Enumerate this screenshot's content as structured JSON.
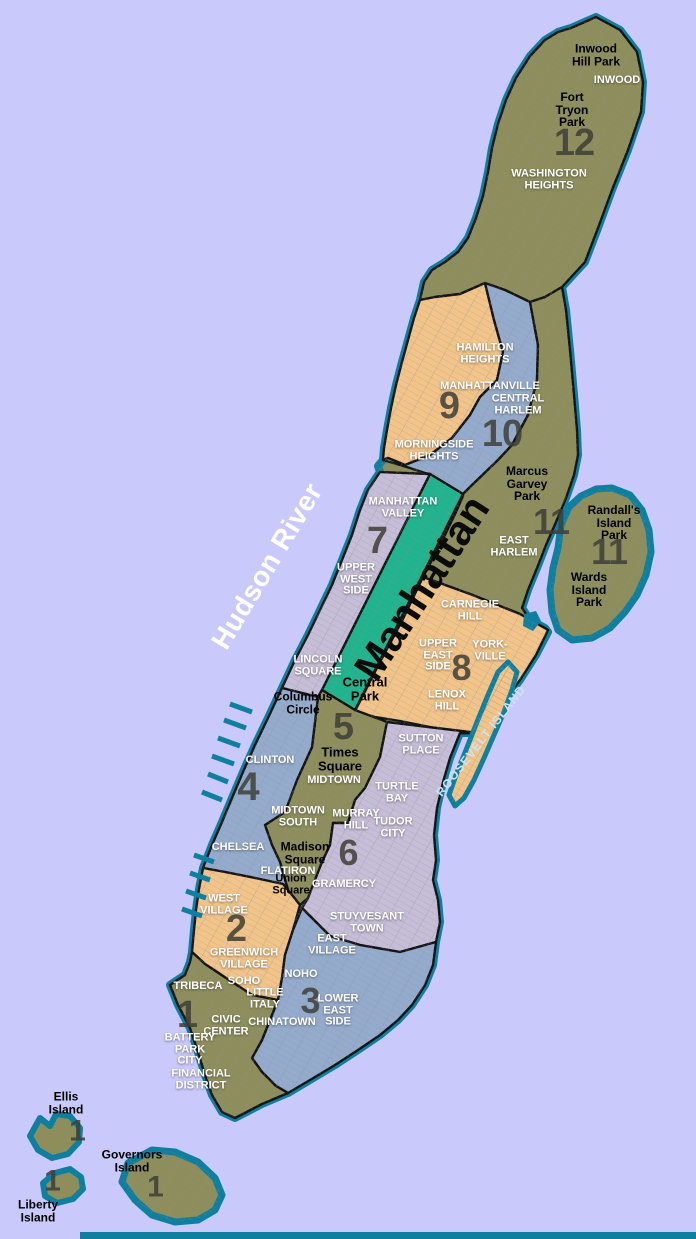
{
  "colors": {
    "water": "#c9c9fb",
    "shore": "#0e7f9e",
    "boundary": "#141414",
    "olive": "#8e8e5c",
    "orange": "#f2c489",
    "blue": "#94abcd",
    "lavender": "#c6bdd8",
    "park": "#1fb48e",
    "street": "#8f8f8f",
    "numeral": "#3f3f37",
    "label_white": "#ffffff",
    "label_black": "#000000",
    "roosevelt_text": "#cfe2f2"
  },
  "map": {
    "width": 696,
    "height": 1239,
    "shapes": [
      {
        "name": "manhattan-island",
        "fill": "olive",
        "stroke": "shore",
        "sw": 8,
        "overlay": true,
        "points": "571,28 596,17 620,30 637,52 643,82 641,112 628,150 612,190 598,228 585,262 562,287 566,310 570,350 574,395 577,430 578,455 574,475 566,498 556,522 546,545 537,568 528,590 522,608 530,620 545,628 548,632 536,655 520,680 505,700 490,718 478,733 460,733 450,758 443,782 437,808 434,835 436,860 433,880 438,900 440,922 436,942 433,965 425,985 412,1005 398,1020 380,1035 358,1050 335,1065 310,1080 288,1093 262,1104 235,1118 222,1112 212,1095 205,1075 198,1052 190,1028 178,1005 170,985 185,975 190,962 192,952 194,930 196,910 199,889 203,868 212,845 222,822 232,798 243,772 255,745 268,718 282,688 295,660 308,635 320,610 332,585 342,560 352,535 360,510 368,490 380,472 378,466 383,460 384,448 387,430 391,408 396,385 402,362 408,340 414,318 420,300 424,282 432,270 445,262 458,252 468,238 476,218 483,196 488,172 492,148 498,124 506,100 516,78 530,56 545,40 558,32"
      },
      {
        "name": "district-12",
        "fill": "olive",
        "stroke": "boundary",
        "sw": 2.4,
        "points": "420,300 435,297 460,294 485,283 505,290 530,302 545,297 562,287 585,262 598,228 612,190 628,150 641,112 643,82 637,52 620,30 596,17 571,28 558,32 545,40 530,56 516,78 506,100 498,124 492,148 488,172 483,196 476,218 468,238 458,252 445,262 432,270 424,282"
      },
      {
        "name": "district-9",
        "fill": "orange",
        "stroke": "boundary",
        "sw": 2.4,
        "points": "420,300 435,297 460,294 485,283 494,320 503,352 497,380 480,397 470,415 452,438 430,455 405,465 388,458 383,460 384,448 387,430 391,408 396,385 402,362 408,340 414,318"
      },
      {
        "name": "district-10",
        "fill": "blue",
        "stroke": "boundary",
        "sw": 2.4,
        "points": "485,283 505,290 530,302 538,345 537,380 528,415 512,445 498,460 470,487 463,494 430,474 425,473 410,468 390,462 383,460 388,458 405,465 430,455 452,438 470,415 480,397 497,380 503,352 494,320"
      },
      {
        "name": "district-11",
        "fill": "olive",
        "stroke": "boundary",
        "sw": 2.4,
        "points": "530,302 545,297 562,287 566,310 570,350 574,395 577,430 578,455 574,475 566,498 556,522 546,545 537,568 528,590 522,608 530,620 545,628 548,630 520,614 470,594 423,577 432,560 445,535 456,512 463,496 463,494 470,487 498,460 512,445 528,415 537,380 538,345"
      },
      {
        "name": "district-7",
        "fill": "lavender",
        "stroke": "boundary",
        "sw": 2.4,
        "points": "380,472 430,474 322,690 318,697 282,688 295,660 308,635 320,610 332,585 342,560 352,535 360,510 368,490"
      },
      {
        "name": "central-park",
        "fill": "park",
        "stroke": "boundary",
        "sw": 2.4,
        "points": "430,474 463,494 355,710 322,690"
      },
      {
        "name": "district-8",
        "fill": "orange",
        "stroke": "boundary",
        "sw": 2.4,
        "points": "423,577 470,594 520,614 548,630 536,655 520,680 505,700 490,718 478,733 460,733 430,727 400,721 375,717 355,711 380,662 402,621"
      },
      {
        "name": "district-5",
        "fill": "olive",
        "stroke": "boundary",
        "sw": 2.4,
        "points": "322,690 355,710 387,722 380,757 365,788 355,800 348,823 333,823 330,845 322,862 315,880 308,898 300,905 288,890 280,862 272,845 265,825 285,812 297,780 312,747 318,697"
      },
      {
        "name": "district-4",
        "fill": "blue",
        "stroke": "boundary",
        "sw": 2.4,
        "points": "282,688 318,697 312,747 297,780 285,812 265,825 272,845 280,862 288,890 283,884 255,878 225,872 203,868 212,845 222,822 232,798 243,772 255,745 268,718"
      },
      {
        "name": "district-6",
        "fill": "lavender",
        "stroke": "boundary",
        "sw": 2.4,
        "points": "387,722 478,733 460,733 450,758 443,782 437,808 434,835 436,860 433,880 438,900 440,922 436,942 400,952 360,945 330,936 302,908 308,898 315,880 322,862 330,845 333,823 348,823 355,800 365,788 380,757"
      },
      {
        "name": "district-2",
        "fill": "orange",
        "stroke": "boundary",
        "sw": 2.4,
        "points": "203,868 225,872 255,878 283,884 288,890 300,905 293,930 285,955 282,978 278,1000 252,995 226,978 205,964 192,952 194,930 196,910 199,889"
      },
      {
        "name": "district-3",
        "fill": "blue",
        "stroke": "boundary",
        "sw": 2.4,
        "points": "302,908 330,936 360,945 400,952 436,942 433,965 425,985 412,1005 398,1020 380,1035 358,1050 335,1065 310,1080 288,1093 276,1086 262,1072 252,1058 262,1040 270,1020 278,1000 282,978 285,955 293,930"
      },
      {
        "name": "district-1",
        "fill": "olive",
        "stroke": "boundary",
        "sw": 2.4,
        "points": "192,952 205,964 226,978 252,995 278,1000 270,1020 262,1040 252,1058 262,1072 276,1086 288,1093 262,1104 235,1118 222,1112 212,1095 205,1075 198,1052 190,1028 178,1005 170,985 185,975 190,962"
      },
      {
        "name": "randalls-wards-island",
        "fill": "olive",
        "stroke": "shore",
        "sw": 7,
        "overlay": true,
        "points": "612,488 630,495 642,510 649,530 651,552 646,575 637,595 625,612 610,628 592,638 572,640 558,630 552,612 550,590 553,568 558,548 561,525 569,507 581,496 596,489"
      },
      {
        "name": "roosevelt-island",
        "fill": "orange",
        "stroke": "shore",
        "sw": 5,
        "overlay": true,
        "points": "508,662 517,672 512,690 504,712 494,735 484,758 474,780 464,798 455,806 449,795 456,775 466,750 477,722 488,695 498,672"
      },
      {
        "name": "governors-island",
        "fill": "olive",
        "stroke": "shore",
        "sw": 7,
        "overlay": true,
        "points": "152,1150 175,1152 198,1162 215,1178 222,1195 215,1210 198,1220 175,1222 152,1215 135,1200 122,1182 128,1163"
      },
      {
        "name": "ellis-island",
        "fill": "olive",
        "stroke": "shore",
        "sw": 6,
        "points": "40,1118 50,1126 56,1114 70,1116 80,1128 79,1142 68,1154 52,1158 38,1150 30,1136"
      },
      {
        "name": "liberty-island",
        "fill": "olive",
        "stroke": "shore",
        "sw": 6,
        "points": "55,1173 70,1169 81,1177 83,1189 73,1199 57,1203 45,1196 43,1183"
      },
      {
        "name": "mill-rock-islet",
        "fill": "shore",
        "stroke": "none",
        "sw": 0,
        "points": "524,614 536,611 541,621 533,631 523,626"
      }
    ],
    "piers": [
      [
        252,
        712,
        230,
        704
      ],
      [
        246,
        728,
        224,
        720
      ],
      [
        240,
        746,
        218,
        738
      ],
      [
        234,
        764,
        212,
        756
      ],
      [
        228,
        782,
        208,
        774
      ],
      [
        222,
        800,
        202,
        792
      ],
      [
        214,
        862,
        194,
        855
      ],
      [
        210,
        880,
        190,
        873
      ],
      [
        206,
        898,
        186,
        891
      ],
      [
        202,
        916,
        182,
        909
      ]
    ],
    "bottom_strip": {
      "x": 80,
      "y": 1232,
      "w": 616,
      "h": 7
    }
  },
  "labels": {
    "places_black": [
      {
        "t": "Inwood\nHill Park",
        "x": 596,
        "y": 55,
        "size": 12
      },
      {
        "t": "Fort\nTryon\nPark",
        "x": 572,
        "y": 110,
        "size": 12
      },
      {
        "t": "Marcus\nGarvey\nPark",
        "x": 527,
        "y": 484,
        "size": 12
      },
      {
        "t": "Randall's\nIsland\nPark",
        "x": 614,
        "y": 523,
        "size": 12
      },
      {
        "t": "Wards\nIsland\nPark",
        "x": 589,
        "y": 590,
        "size": 12
      },
      {
        "t": "Central\nPark",
        "x": 365,
        "y": 689,
        "size": 13
      },
      {
        "t": "Columbus\nCircle",
        "x": 303,
        "y": 703,
        "size": 12
      },
      {
        "t": "Times\nSquare",
        "x": 340,
        "y": 759,
        "size": 13
      },
      {
        "t": "Madison\nSquare",
        "x": 305,
        "y": 853,
        "size": 12
      },
      {
        "t": "Union\nSquare",
        "x": 291,
        "y": 885,
        "size": 11
      },
      {
        "t": "Ellis\nIsland",
        "x": 66,
        "y": 1103,
        "size": 12
      },
      {
        "t": "Governors\nIsland",
        "x": 132,
        "y": 1161,
        "size": 12
      },
      {
        "t": "Liberty\nIsland",
        "x": 38,
        "y": 1211,
        "size": 12
      }
    ],
    "places_white": [
      {
        "t": "INWOOD",
        "x": 617,
        "y": 81,
        "size": 11
      },
      {
        "t": "WASHINGTON\nHEIGHTS",
        "x": 549,
        "y": 180,
        "size": 11
      },
      {
        "t": "HAMILTON\nHEIGHTS",
        "x": 485,
        "y": 354,
        "size": 11
      },
      {
        "t": "MANHATTANVILLE",
        "x": 490,
        "y": 387,
        "size": 11
      },
      {
        "t": "CENTRAL\nHARLEM",
        "x": 518,
        "y": 405,
        "size": 11
      },
      {
        "t": "MORNINGSIDE\nHEIGHTS",
        "x": 434,
        "y": 451,
        "size": 11
      },
      {
        "t": "EAST\nHARLEM",
        "x": 514,
        "y": 547,
        "size": 11
      },
      {
        "t": "MANHATTAN\nVALLEY",
        "x": 403,
        "y": 508,
        "size": 11
      },
      {
        "t": "UPPER\nWEST\nSIDE",
        "x": 356,
        "y": 580,
        "size": 11
      },
      {
        "t": "LINCOLN\nSQUARE",
        "x": 318,
        "y": 666,
        "size": 11
      },
      {
        "t": "CARNEGIE\nHILL",
        "x": 470,
        "y": 611,
        "size": 11
      },
      {
        "t": "UPPER\nEAST\nSIDE",
        "x": 438,
        "y": 656,
        "size": 11
      },
      {
        "t": "YORK-\nVILLE",
        "x": 490,
        "y": 651,
        "size": 11
      },
      {
        "t": "LENOX\nHILL",
        "x": 447,
        "y": 701,
        "size": 11
      },
      {
        "t": "CLINTON",
        "x": 270,
        "y": 761,
        "size": 11
      },
      {
        "t": "MIDTOWN",
        "x": 334,
        "y": 781,
        "size": 11
      },
      {
        "t": "MIDTOWN\nSOUTH",
        "x": 298,
        "y": 817,
        "size": 11
      },
      {
        "t": "SUTTON\nPLACE",
        "x": 421,
        "y": 745,
        "size": 11
      },
      {
        "t": "TURTLE\nBAY",
        "x": 397,
        "y": 793,
        "size": 11
      },
      {
        "t": "MURRAY\nHILL",
        "x": 356,
        "y": 820,
        "size": 11
      },
      {
        "t": "TUDOR\nCITY",
        "x": 393,
        "y": 828,
        "size": 11
      },
      {
        "t": "CHELSEA",
        "x": 238,
        "y": 848,
        "size": 11
      },
      {
        "t": "FLATIRON",
        "x": 288,
        "y": 872,
        "size": 11
      },
      {
        "t": "GRAMERCY",
        "x": 344,
        "y": 885,
        "size": 11
      },
      {
        "t": "STUYVESANT\nTOWN",
        "x": 367,
        "y": 923,
        "size": 11
      },
      {
        "t": "WEST\nVILLAGE",
        "x": 224,
        "y": 905,
        "size": 11
      },
      {
        "t": "GREENWICH\nVILLAGE",
        "x": 244,
        "y": 959,
        "size": 11
      },
      {
        "t": "SOHO",
        "x": 244,
        "y": 982,
        "size": 11
      },
      {
        "t": "LITTLE\nITALY",
        "x": 265,
        "y": 999,
        "size": 11
      },
      {
        "t": "NOHO",
        "x": 301,
        "y": 975,
        "size": 11
      },
      {
        "t": "EAST\nVILLAGE",
        "x": 332,
        "y": 945,
        "size": 11
      },
      {
        "t": "LOWER\nEAST\nSIDE",
        "x": 338,
        "y": 1011,
        "size": 11
      },
      {
        "t": "CHINATOWN",
        "x": 282,
        "y": 1023,
        "size": 11
      },
      {
        "t": "TRIBECA",
        "x": 198,
        "y": 987,
        "size": 11
      },
      {
        "t": "CIVIC\nCENTER",
        "x": 226,
        "y": 1026,
        "size": 11
      },
      {
        "t": "BATTERY\nPARK\nCITY",
        "x": 190,
        "y": 1050,
        "size": 11
      },
      {
        "t": "FINANCIAL\nDISTRICT",
        "x": 201,
        "y": 1080,
        "size": 11
      }
    ],
    "district_numbers": [
      {
        "t": "12",
        "x": 574,
        "y": 144,
        "size": 38
      },
      {
        "t": "9",
        "x": 449,
        "y": 407,
        "size": 38
      },
      {
        "t": "10",
        "x": 502,
        "y": 435,
        "size": 38
      },
      {
        "t": "11",
        "x": 551,
        "y": 522,
        "size": 36
      },
      {
        "t": "11",
        "x": 609,
        "y": 552,
        "size": 36
      },
      {
        "t": "7",
        "x": 377,
        "y": 542,
        "size": 38
      },
      {
        "t": "8",
        "x": 461,
        "y": 668,
        "size": 36
      },
      {
        "t": "5",
        "x": 343,
        "y": 728,
        "size": 38
      },
      {
        "t": "4",
        "x": 248,
        "y": 787,
        "size": 40
      },
      {
        "t": "6",
        "x": 348,
        "y": 853,
        "size": 36
      },
      {
        "t": "2",
        "x": 236,
        "y": 930,
        "size": 38
      },
      {
        "t": "3",
        "x": 310,
        "y": 1001,
        "size": 36
      },
      {
        "t": "1",
        "x": 187,
        "y": 1016,
        "size": 38
      },
      {
        "t": "1",
        "x": 77,
        "y": 1131,
        "size": 30
      },
      {
        "t": "1",
        "x": 52,
        "y": 1181,
        "size": 30
      },
      {
        "t": "1",
        "x": 155,
        "y": 1187,
        "size": 30
      }
    ],
    "rotated": [
      {
        "t": "Manhattan",
        "x": 422,
        "y": 588,
        "rotate": -57,
        "size": 42,
        "color": "#0b0b0b",
        "weight": 800,
        "spacing": 0
      },
      {
        "t": "Hudson River",
        "x": 267,
        "y": 566,
        "rotate": -59,
        "size": 28,
        "color": "#ffffff",
        "weight": 600,
        "spacing": 0.5
      },
      {
        "t": "ROOSEVELT ISLAND",
        "x": 481,
        "y": 741,
        "rotate": -52,
        "size": 12,
        "color": "#cfe2f2",
        "weight": 700,
        "spacing": 1
      }
    ]
  }
}
